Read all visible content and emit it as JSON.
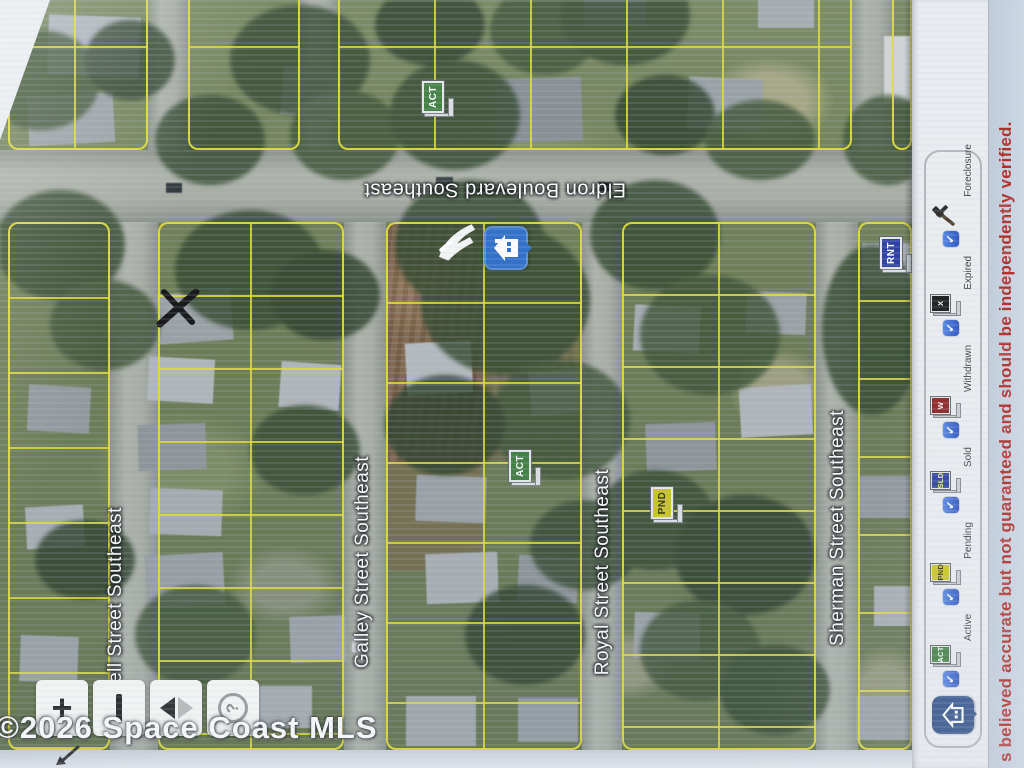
{
  "map": {
    "streets": {
      "eldron": "Eldron Boulevard Southeast",
      "galley": "Galley Street Southeast",
      "royal": "Royal Street Southeast",
      "sherman": "Sherman Street Southeast",
      "kell": "kell Street Southeast"
    },
    "markers": {
      "act_top": "ACT",
      "act_mid": "ACT",
      "pnd": "PND",
      "rnt": "RNT"
    },
    "watermark": "©2026 Space Coast MLS"
  },
  "controls": {
    "zoom_in": "+",
    "zoom_out": "−",
    "nav_back": "◀",
    "nav_forward": "▶",
    "help": "?"
  },
  "legend": {
    "items": [
      {
        "label": "Active",
        "flag": "ACT",
        "color": "#3f7d3c",
        "text_color": "#ffffff"
      },
      {
        "label": "Pending",
        "flag": "PND",
        "color": "#cdc51f",
        "text_color": "#2f2f10"
      },
      {
        "label": "Sold",
        "flag": "SLD",
        "color": "#2c3fa0",
        "text_color": "#ffe9a8"
      },
      {
        "label": "Withdrawn",
        "flag": "W",
        "color": "#8e2424",
        "text_color": "#ffffff"
      },
      {
        "label": "Expired",
        "flag": "X",
        "color": "#1e1e1e",
        "text_color": "#ffffff"
      },
      {
        "label": "Foreclosure",
        "flag": "",
        "color": "",
        "text_color": ""
      }
    ]
  },
  "disclaimer": "s believed accurate but not guaranteed and should be independently verified.",
  "colors": {
    "parcel_line": "#e4dd30",
    "selected_pin": "#2f6fc9",
    "checkbox_blue": "#3e6ed6",
    "disclaimer_red": "#b02822"
  }
}
